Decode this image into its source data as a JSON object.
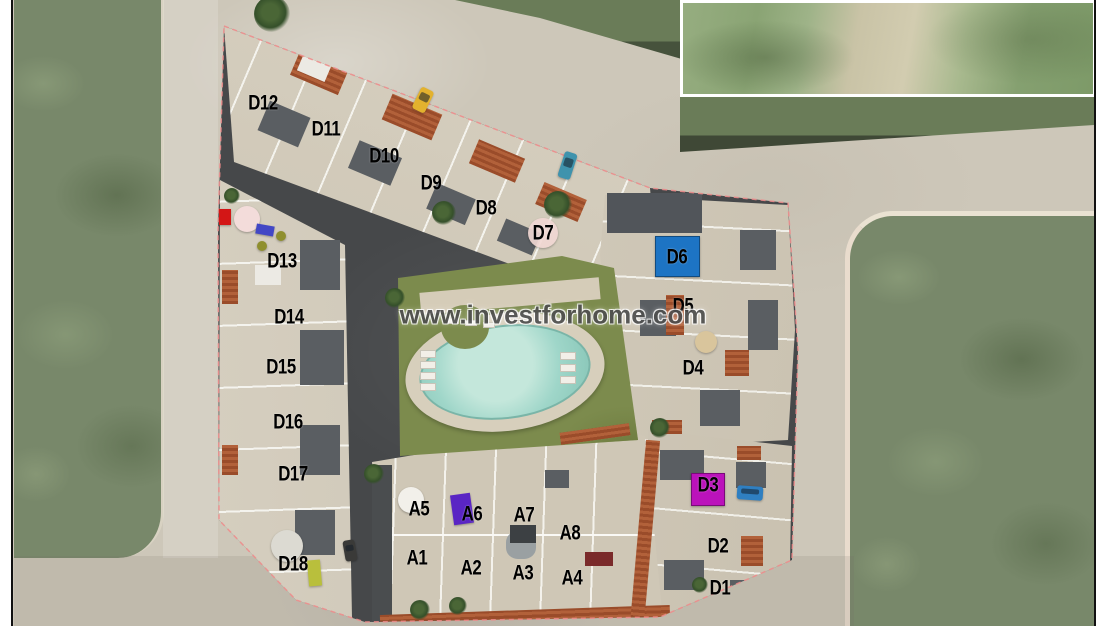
{
  "watermark": {
    "text": "www.investforhome.com"
  },
  "development": {
    "d_units": [
      {
        "id": "D12",
        "x": 263,
        "y": 103
      },
      {
        "id": "D11",
        "x": 326,
        "y": 129
      },
      {
        "id": "D10",
        "x": 384,
        "y": 156
      },
      {
        "id": "D9",
        "x": 431,
        "y": 183
      },
      {
        "id": "D8",
        "x": 486,
        "y": 208
      },
      {
        "id": "D7",
        "x": 543,
        "y": 233
      },
      {
        "id": "D13",
        "x": 282,
        "y": 261
      },
      {
        "id": "D14",
        "x": 289,
        "y": 317
      },
      {
        "id": "D15",
        "x": 281,
        "y": 367
      },
      {
        "id": "D16",
        "x": 288,
        "y": 422
      },
      {
        "id": "D17",
        "x": 293,
        "y": 474
      },
      {
        "id": "D18",
        "x": 293,
        "y": 564
      },
      {
        "id": "D6",
        "x": 677,
        "y": 257
      },
      {
        "id": "D5",
        "x": 683,
        "y": 306
      },
      {
        "id": "D4",
        "x": 693,
        "y": 368
      },
      {
        "id": "D3",
        "x": 708,
        "y": 485
      },
      {
        "id": "D2",
        "x": 718,
        "y": 546
      },
      {
        "id": "D1",
        "x": 720,
        "y": 588
      }
    ],
    "a_units": [
      {
        "id": "A5",
        "x": 419,
        "y": 509
      },
      {
        "id": "A6",
        "x": 472,
        "y": 514
      },
      {
        "id": "A7",
        "x": 524,
        "y": 515
      },
      {
        "id": "A8",
        "x": 570,
        "y": 533
      },
      {
        "id": "A1",
        "x": 417,
        "y": 558
      },
      {
        "id": "A2",
        "x": 471,
        "y": 568
      },
      {
        "id": "A3",
        "x": 523,
        "y": 573
      },
      {
        "id": "A4",
        "x": 572,
        "y": 578
      }
    ]
  },
  "props": [
    {
      "name": "unit-d6-highlight",
      "x": 655,
      "y": 236,
      "w": 45,
      "h": 41,
      "color": "#1d74c4"
    },
    {
      "name": "unit-d3-highlight",
      "x": 691,
      "y": 473,
      "w": 34,
      "h": 33,
      "color": "#bb12bb"
    },
    {
      "name": "pink-circle-d7",
      "x": 543,
      "y": 233,
      "r": 15,
      "color": "#f2d8d4",
      "opacity": 0.9
    },
    {
      "name": "pink-parasol",
      "x": 247,
      "y": 219,
      "r": 13,
      "color": "#f3dcda"
    },
    {
      "name": "red-chair",
      "x": 219,
      "y": 209,
      "w": 12,
      "h": 16,
      "color": "#d31616"
    },
    {
      "name": "blue-lounger",
      "x": 256,
      "y": 225,
      "w": 18,
      "h": 10,
      "rot": 10,
      "color": "#4247c5"
    },
    {
      "name": "olive-table-1",
      "x": 281,
      "y": 236,
      "r": 5,
      "color": "#8f8f2e"
    },
    {
      "name": "olive-table-2",
      "x": 262,
      "y": 246,
      "r": 5,
      "color": "#8f8f2e"
    },
    {
      "name": "yellow-car",
      "x": 416,
      "y": 88,
      "w": 14,
      "h": 24,
      "rot": 26,
      "color": "#e3b22e"
    },
    {
      "name": "blue-car",
      "x": 561,
      "y": 152,
      "w": 13,
      "h": 27,
      "rot": 18,
      "color": "#3f93ad"
    },
    {
      "name": "blue-truck",
      "x": 737,
      "y": 486,
      "w": 26,
      "h": 14,
      "rot": 4,
      "color": "#2f7fc1"
    },
    {
      "name": "dark-car",
      "x": 344,
      "y": 540,
      "w": 12,
      "h": 21,
      "rot": -10,
      "color": "#3a3a38"
    },
    {
      "name": "lime-container",
      "x": 308,
      "y": 560,
      "w": 13,
      "h": 26,
      "rot": -5,
      "color": "#b9bf3c"
    },
    {
      "name": "purple-loungers",
      "x": 452,
      "y": 494,
      "w": 20,
      "h": 30,
      "rot": -8,
      "color": "#5a25c4"
    },
    {
      "name": "white-tank",
      "x": 287,
      "y": 546,
      "r": 16,
      "color": "#dcdad2"
    },
    {
      "name": "spiral-stair",
      "x": 411,
      "y": 500,
      "r": 13,
      "color": "#f2f0ea"
    },
    {
      "name": "tan-parasol",
      "x": 706,
      "y": 342,
      "r": 11,
      "color": "#d9c59c"
    },
    {
      "name": "palm-tree-1",
      "x": 272,
      "y": 14,
      "r": 18
    },
    {
      "name": "palm-tree-2",
      "x": 558,
      "y": 205,
      "r": 14
    },
    {
      "name": "palm-tree-3",
      "x": 444,
      "y": 213,
      "r": 12
    },
    {
      "name": "palm-tree-4",
      "x": 395,
      "y": 298,
      "r": 10
    },
    {
      "name": "palm-tree-5",
      "x": 374,
      "y": 474,
      "r": 10
    },
    {
      "name": "palm-tree-6",
      "x": 660,
      "y": 428,
      "r": 10
    },
    {
      "name": "palm-tree-7",
      "x": 420,
      "y": 610,
      "r": 10
    },
    {
      "name": "palm-tree-8",
      "x": 458,
      "y": 606,
      "r": 9
    },
    {
      "name": "palm-tree-9",
      "x": 700,
      "y": 585,
      "r": 8
    },
    {
      "name": "palm-tree-10",
      "x": 232,
      "y": 196,
      "r": 8
    }
  ],
  "colors": {
    "pool_water": "#9fd6c9",
    "lawn": "#7c8b4d",
    "site_street": "#46484a",
    "building_roof_terrace": "#d3ccbb",
    "terracotta_roof": "#9c4f2b",
    "road": "#cdc7b9",
    "satellite_grass": "#78886a",
    "unit_d6_highlight": "#1d74c4",
    "unit_d3_highlight": "#bb12bb",
    "label_text": "#000000",
    "watermark_text": "#4f4f4f",
    "boundary_dash": "#f08c8c"
  }
}
